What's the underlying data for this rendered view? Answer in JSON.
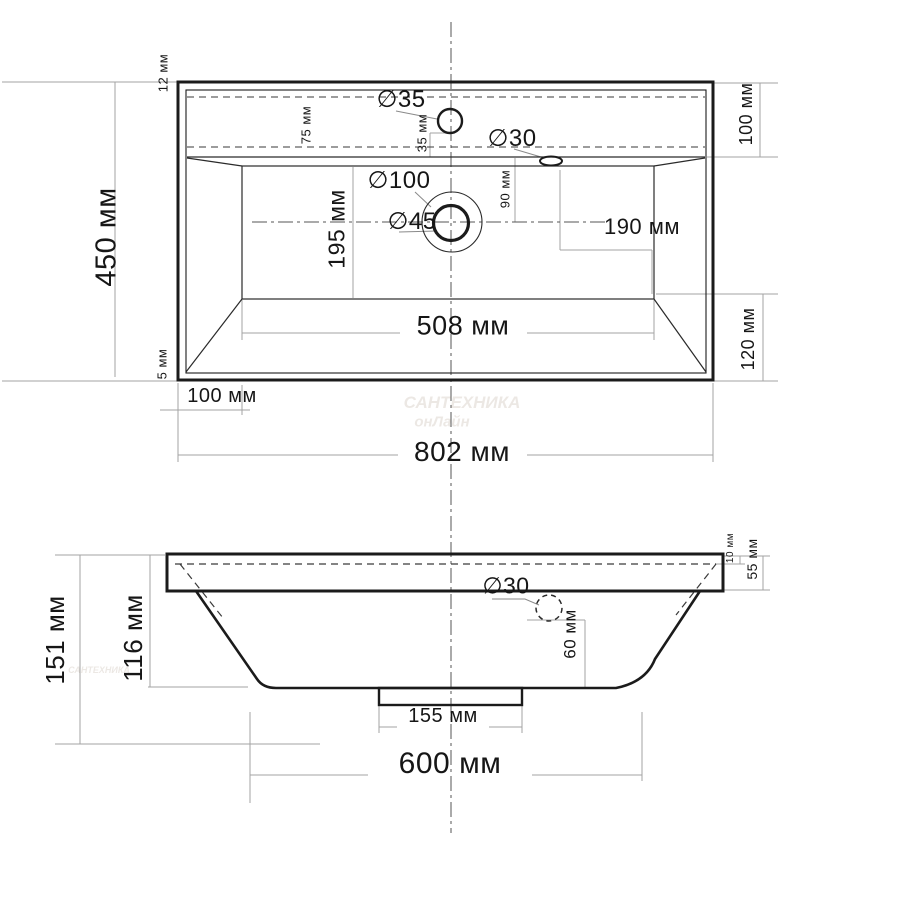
{
  "top_view": {
    "edge_thickness": "12 мм",
    "overall_depth": "450 мм",
    "front_edge": "5 мм",
    "faucet_hole_diameter": "∅35",
    "back_offset": "75 мм",
    "faucet_center_offset": "35 мм",
    "overflow_diameter": "∅30",
    "back_shelf_depth": "100 мм",
    "drain_recess_diameter": "∅100",
    "drain_diameter": "∅45",
    "overflow_front_offset": "90 мм",
    "overflow_side_offset": "190 мм",
    "bowl_depth": "195 мм",
    "bowl_width": "508 мм",
    "front_section_depth": "120 мм",
    "side_inset": "100 мм",
    "overall_width": "802 мм"
  },
  "side_view": {
    "overall_height": "151 мм",
    "bowl_height": "116 мм",
    "overflow_diameter": "∅30",
    "overflow_height": "60 мм",
    "top_lip": "10 мм",
    "rim_height": "55 мм",
    "drain_base_width": "155 мм",
    "bottom_width": "600 мм"
  },
  "watermark": {
    "line1": "САНТЕХНИКА",
    "line2": "онЛайн"
  }
}
